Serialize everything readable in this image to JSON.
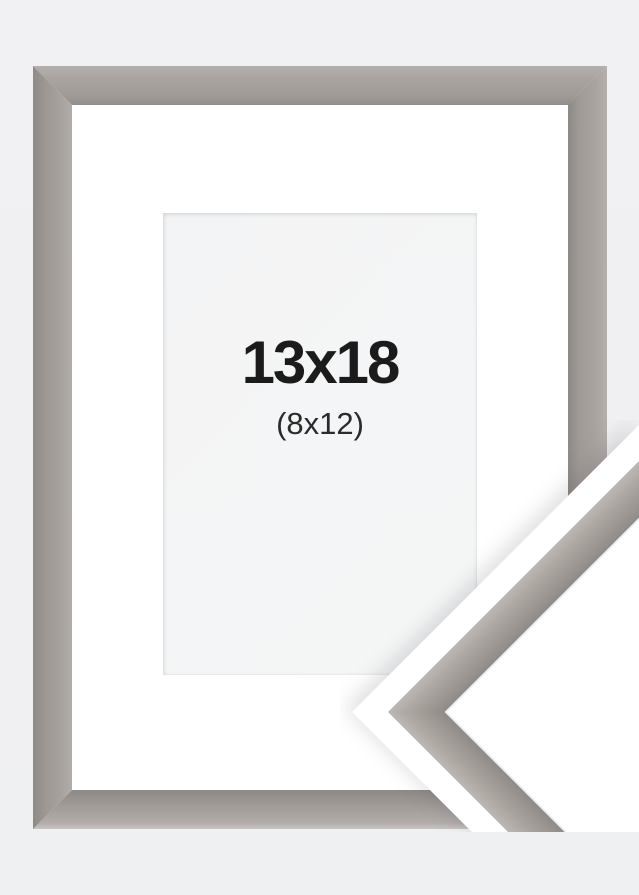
{
  "product_image": {
    "type": "picture-frame-size-mockup",
    "size_label": "13x18",
    "size_sublabel": "(8x12)",
    "colors": {
      "page_background": "#f0f0f2",
      "frame_face": "#a49e9a",
      "frame_highlight": "#b9b4b1",
      "frame_shadow": "#8d8885",
      "mat": "#ffffff",
      "opening_background": "#f4f5f6",
      "cutout_band": "#ffffff",
      "label_color": "#1b1b1b",
      "sublabel_color": "#2b2b2b"
    }
  }
}
